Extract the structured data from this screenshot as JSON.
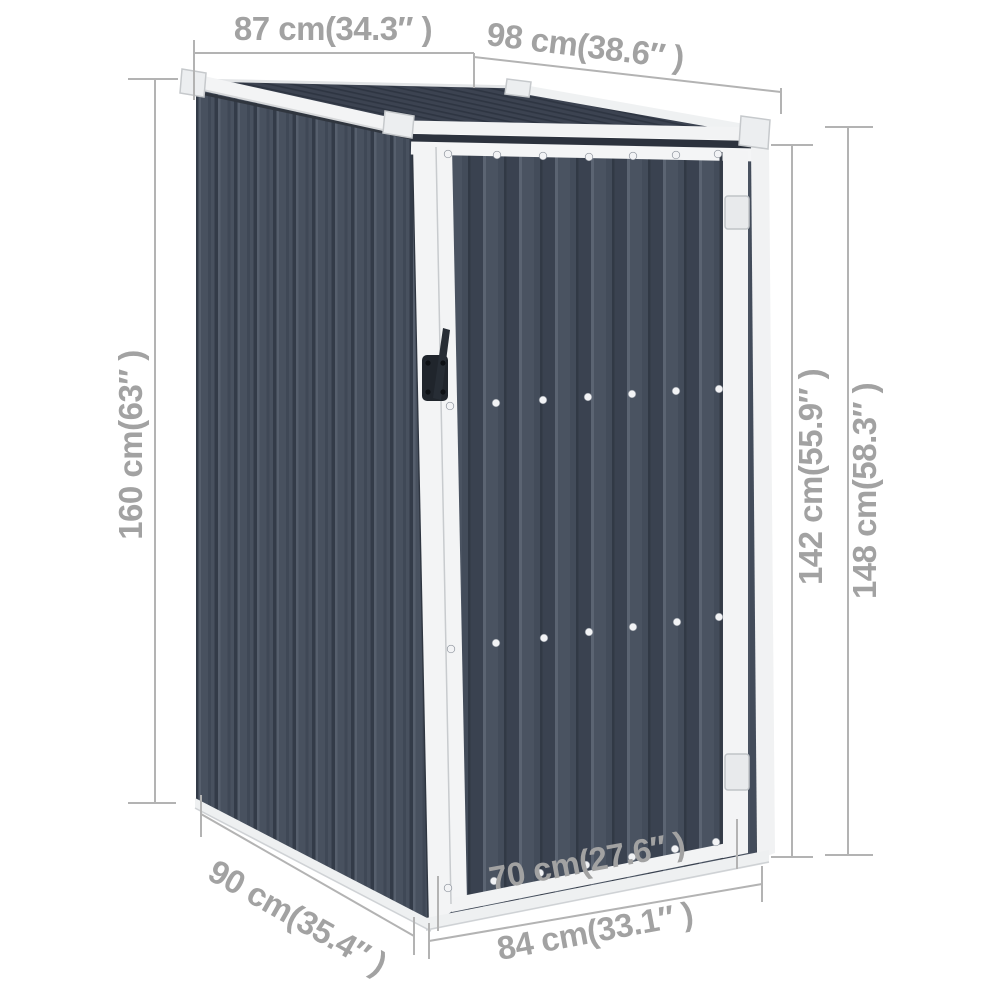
{
  "diagram": {
    "subject": "Anthracite metal garden shed — product dimension drawing",
    "view": "three-quarter perspective, front door visible"
  },
  "colors": {
    "background": "#ffffff",
    "dimension_line": "#b3b3b3",
    "dimension_text": "#a2a2a2",
    "panel_front": "#4a5361",
    "panel_groove": "#3a4250",
    "panel_side": "#48515f",
    "roof": "#3c4351",
    "trim_white": "#f2f3f4",
    "handle_black": "#20252c"
  },
  "dimensions": {
    "roof_depth": "87 cm(34.3″ )",
    "roof_width": "98 cm(38.6″ )",
    "rear_height": "160 cm(63″ )",
    "door_height": "142 cm(55.9″ )",
    "front_height": "148 cm(58.3″ )",
    "base_depth": "90 cm(35.4″ )",
    "door_width": "70 cm(27.6″ )",
    "base_width": "84 cm(33.1″ )"
  }
}
